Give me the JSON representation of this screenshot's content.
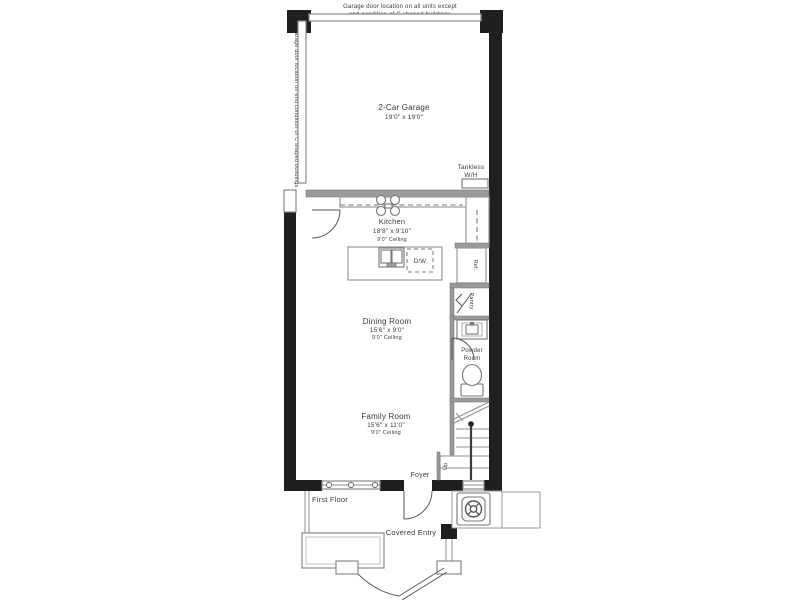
{
  "annotations": {
    "top_line1": "Garage door location on all units except",
    "top_line2": "end condition of C shaped buildings",
    "side_note": "Garage door location on end condition of C shaped buildings"
  },
  "rooms": {
    "garage": {
      "name": "2-Car Garage",
      "dims": "19'0\" x 19'0\""
    },
    "kitchen": {
      "name": "Kitchen",
      "dims": "18'8\" x 9'10\"",
      "ceiling": "9'0\" Ceiling"
    },
    "dining": {
      "name": "Dining Room",
      "dims": "15'6\" x 9'0\"",
      "ceiling": "9'0\" Ceiling"
    },
    "family": {
      "name": "Family Room",
      "dims": "15'6\" x 11'0\"",
      "ceiling": "9'0\" Ceiling"
    },
    "powder": {
      "line1": "Powder",
      "line2": "Room"
    },
    "foyer": {
      "label": "Foyer"
    },
    "covered_entry": {
      "label": "Covered Entry"
    },
    "pantry": {
      "label": "Pantry"
    }
  },
  "fixtures": {
    "tankless": {
      "line1": "Tankless",
      "line2": "W/H"
    },
    "dishwasher": {
      "label": "D/W"
    },
    "refrigerator": {
      "label": "Ref."
    },
    "stairs": {
      "up_label": "Up"
    }
  },
  "floor": {
    "label": "First Floor"
  },
  "colors": {
    "wall": "#1f1f1f",
    "interior_wall": "#9a9a9a",
    "line": "#8a8a8a",
    "text": "#3c3c3c"
  }
}
